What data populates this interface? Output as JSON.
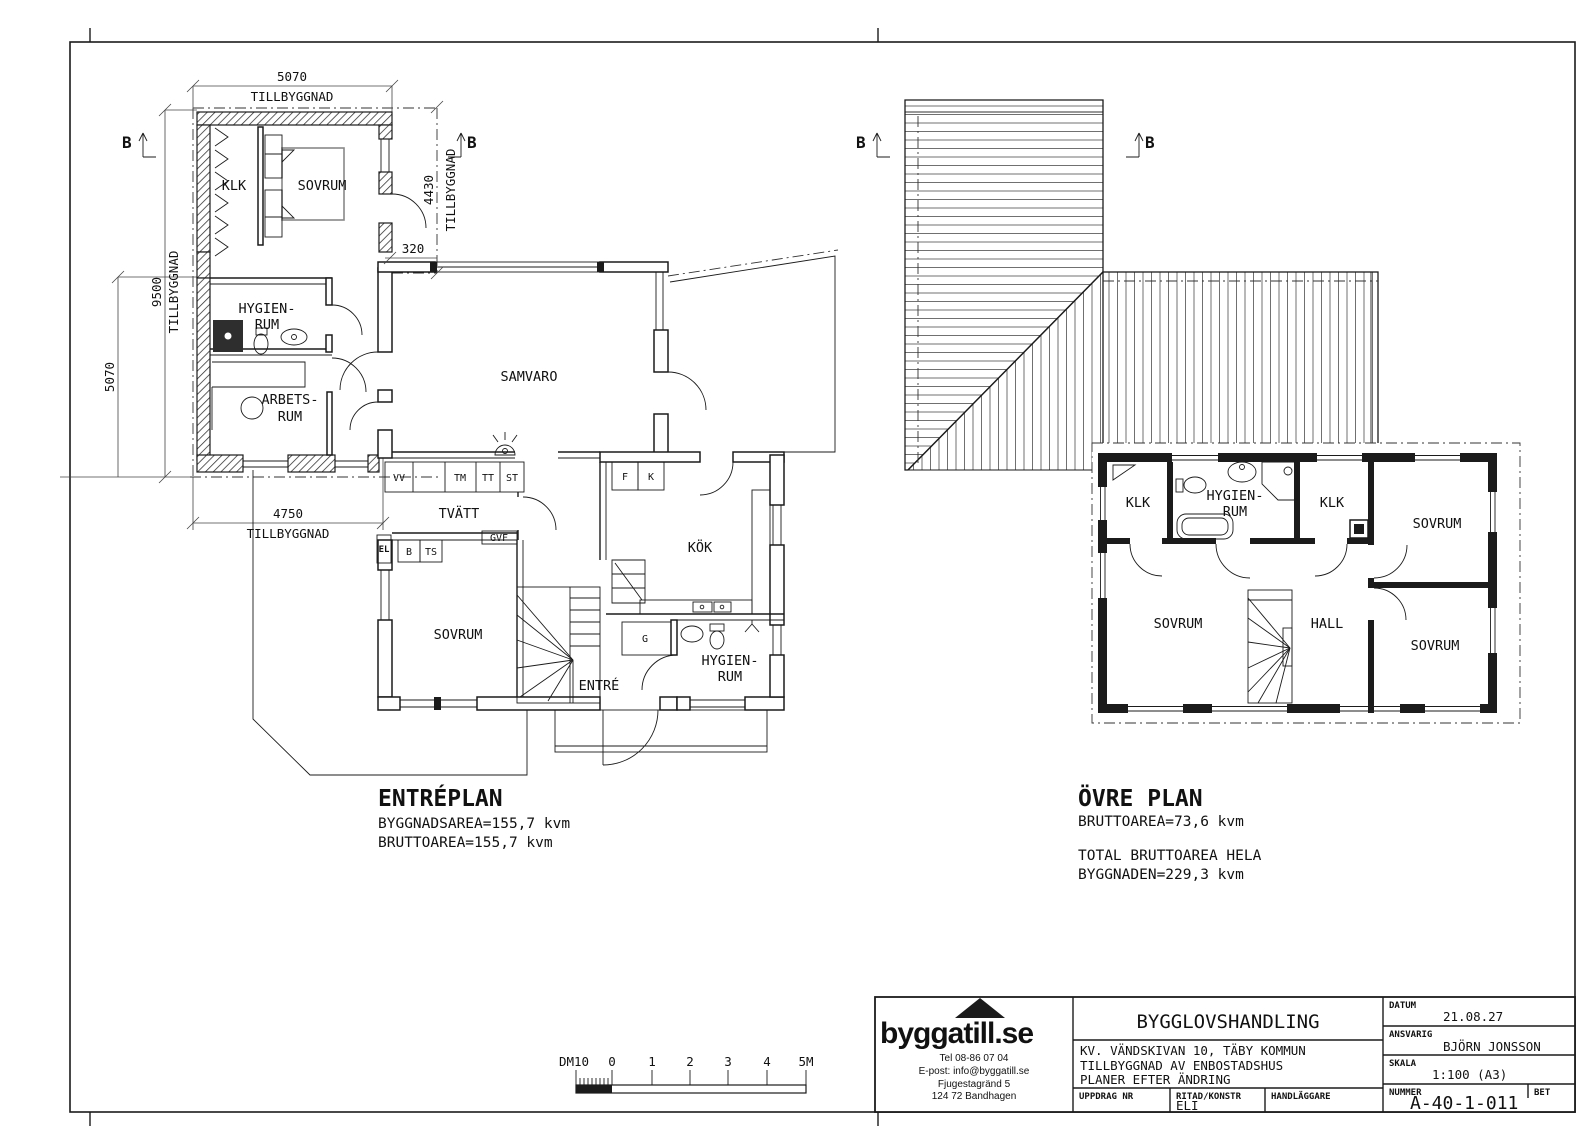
{
  "section_marker": "B",
  "entreplan": {
    "title": "ENTRÉPLAN",
    "area_lines": [
      "BYGGNADSAREA=155,7 kvm",
      "BRUTTOAREA=155,7 kvm"
    ],
    "rooms": {
      "klk": "KLK",
      "sovrum_top": "SOVRUM",
      "hygien1": "HYGIEN-",
      "hygien2": "RUM",
      "arbets1": "ARBETS-",
      "arbets2": "RUM",
      "samvaro": "SAMVARO",
      "tvatt": "TVÄTT",
      "kok": "KÖK",
      "sovrum_bottom": "SOVRUM",
      "entre": "ENTRÉ",
      "hygien_b1": "HYGIEN-",
      "hygien_b2": "RUM",
      "g": "G"
    },
    "appliances": {
      "vv": "VV",
      "tm": "TM",
      "tt": "TT",
      "st": "ST",
      "b": "B",
      "ts": "TS",
      "gvf": "GVF",
      "el": "EL",
      "f": "F",
      "k": "K"
    },
    "dims": {
      "top": "5070",
      "top_label": "TILLBYGGNAD",
      "left_outer": "9500",
      "left_outer_label": "TILLBYGGNAD",
      "left_inner": "5070",
      "bottom": "4750",
      "bottom_label": "TILLBYGGNAD",
      "right": "4430",
      "right_label": "TILLBYGGNAD",
      "offset": "320"
    }
  },
  "ovreplan": {
    "title": "ÖVRE PLAN",
    "area_lines": [
      "BRUTTOAREA=73,6 kvm",
      "TOTAL BRUTTOAREA HELA",
      "BYGGNADEN=229,3 kvm"
    ],
    "rooms": {
      "klk1": "KLK",
      "hygien1": "HYGIEN-",
      "hygien2": "RUM",
      "klk2": "KLK",
      "sovrum_tr": "SOVRUM",
      "sovrum_l": "SOVRUM",
      "hall": "HALL",
      "sovrum_br": "SOVRUM"
    }
  },
  "scalebar": {
    "labels": [
      "DM10",
      "0",
      "1",
      "2",
      "3",
      "4",
      "5M"
    ]
  },
  "titleblock": {
    "logo_text": "byggatill.se",
    "contact": [
      "Tel 08-86 07 04",
      "E-post: info@byggatill.se",
      "Fjugestagränd 5",
      "124 72 Bandhagen"
    ],
    "doc_type": "BYGGLOVSHANDLING",
    "project_lines": [
      "KV. VÄNDSKIVAN 10, TÄBY KOMMUN",
      "TILLBYGGNAD AV ENBOSTADSHUS",
      "PLANER EFTER ÄNDRING"
    ],
    "fields": {
      "datum_label": "DATUM",
      "datum": "21.08.27",
      "ansvarig_label": "ANSVARIG",
      "ansvarig": "BJÖRN JONSSON",
      "skala_label": "SKALA",
      "skala": "1:100 (A3)",
      "uppdrag_label": "UPPDRAG NR",
      "ritad_label": "RITAD/KONSTR",
      "ritad": "ELI",
      "handlaggare_label": "HANDLÄGGARE",
      "nummer_label": "NUMMER",
      "nummer": "A-40-1-011",
      "bet_label": "BET"
    }
  }
}
